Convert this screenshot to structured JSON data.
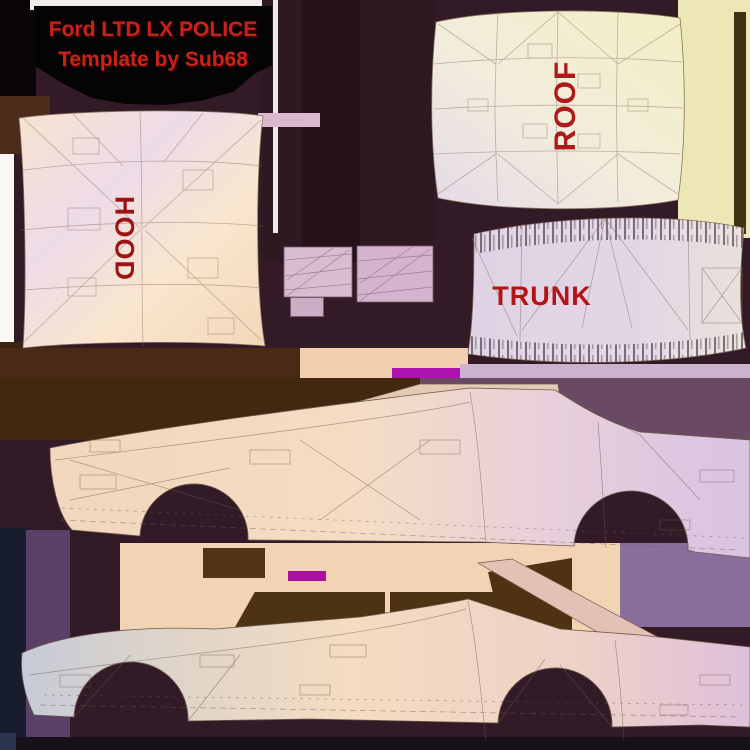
{
  "title": {
    "line1": "Ford LTD LX POLICE",
    "line2": "Template by Sub68",
    "text_color": "#c8231b",
    "background_color": "#060305"
  },
  "labels": {
    "hood": "HOOD",
    "roof": "ROOF",
    "trunk": "TRUNK",
    "label_color": "#a51515"
  },
  "panels": [
    {
      "name": "hood",
      "label": "HOOD",
      "fill": "#f6e2c9"
    },
    {
      "name": "roof",
      "label": "ROOF",
      "fill": "#f1ecd9"
    },
    {
      "name": "trunk",
      "label": "TRUNK",
      "fill": "#ddd1e3"
    },
    {
      "name": "upper-side-view",
      "label": "",
      "fill": "#f2d8bc"
    },
    {
      "name": "lower-side-view",
      "label": "",
      "fill": "#e8d2c4"
    },
    {
      "name": "bumper-part-left",
      "label": "",
      "fill": "#d9bcd2"
    },
    {
      "name": "bumper-part-right",
      "label": "",
      "fill": "#d4b4cc"
    }
  ],
  "colors": {
    "background_maroon": "#321b26",
    "background_brown": "#4a2a14",
    "background_navy": "#171d2c",
    "yellow_corner": "#ece7b4",
    "magenta_patch": "#ae12ae",
    "body_peach": "#f2d8bc",
    "body_pink": "#dfc4e0",
    "body_grey": "#c9cdd9",
    "wireframe_line": "#6e5a4e"
  }
}
